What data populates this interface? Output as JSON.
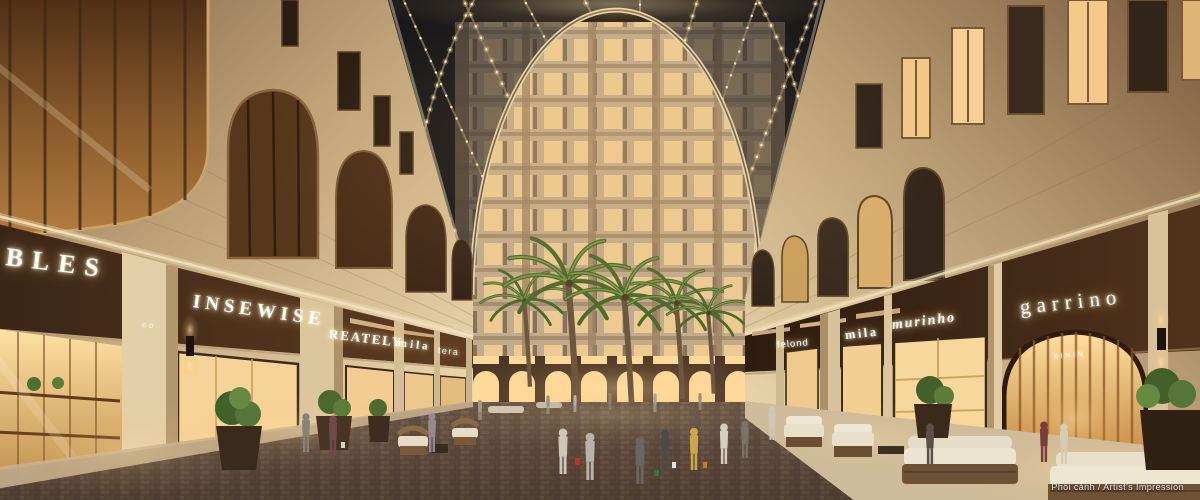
{
  "scene": {
    "setting": "Covered retail arcade street at dusk: glass vaulted canopy with string lights, classical stone facades, palm trees, shoppers",
    "watermark": "Phối cảnh / Artist's Impression"
  },
  "signs": {
    "left": [
      {
        "id": "bles",
        "label": "BLES"
      },
      {
        "id": "window-co",
        "label": "co"
      },
      {
        "id": "insewise",
        "label": "INSEWISE"
      },
      {
        "id": "reately",
        "label": "REATELY"
      },
      {
        "id": "mila-left",
        "label": "mila"
      },
      {
        "id": "tera",
        "label": "tera"
      }
    ],
    "right": [
      {
        "id": "felond",
        "label": "felond"
      },
      {
        "id": "mila-right",
        "label": "mila"
      },
      {
        "id": "murinho",
        "label": "murinho"
      },
      {
        "id": "garrino",
        "label": "garrino"
      },
      {
        "id": "xinin",
        "label": "XININ"
      }
    ]
  },
  "colors": {
    "stone": "#cdb493",
    "wood": "#8a5a2e",
    "sign_glow": "#fff6e6",
    "canopy_lights": "#ffe6a8",
    "glass": "#23262e",
    "street": "#6b5546",
    "tower_window": "#f2d0a0",
    "palm": "#51702e"
  }
}
